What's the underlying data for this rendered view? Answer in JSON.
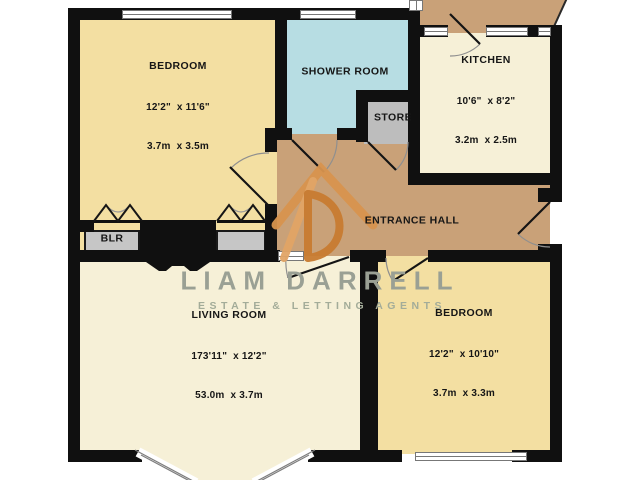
{
  "watermark": {
    "title": "LIAM DARRELL",
    "subtitle": "ESTATE & LETTING AGENTS"
  },
  "rooms": [
    {
      "name": "BEDROOM",
      "dims_ft": "12'2\"  x 11'6\"",
      "dims_m": "3.7m  x 3.5m"
    },
    {
      "name": "SHOWER ROOM",
      "dims_ft": "",
      "dims_m": ""
    },
    {
      "name": "KITCHEN",
      "dims_ft": "10'6\"  x 8'2\"",
      "dims_m": "3.2m  x 2.5m"
    },
    {
      "name": "STORE",
      "dims_ft": "",
      "dims_m": ""
    },
    {
      "name": "ENTRANCE HALL",
      "dims_ft": "",
      "dims_m": ""
    },
    {
      "name": "BLR",
      "dims_ft": "",
      "dims_m": ""
    },
    {
      "name": "LIVING ROOM",
      "dims_ft": "173'11\"  x 12'2\"",
      "dims_m": "53.0m  x 3.7m"
    },
    {
      "name": "BEDROOM",
      "dims_ft": "12'2\"  x 10'10\"",
      "dims_m": "3.7m  x 3.3m"
    }
  ],
  "colors": {
    "wall": "#101010",
    "bedroom_fill": "#f3dfa2",
    "shower_fill": "#b7dde3",
    "kitchen_living_fill": "#f6f0d7",
    "hall_fill": "#c9a178",
    "store_fill": "#bdbdbd",
    "logo_orange": "#d8944e",
    "watermark_gray": "#9aa094"
  }
}
